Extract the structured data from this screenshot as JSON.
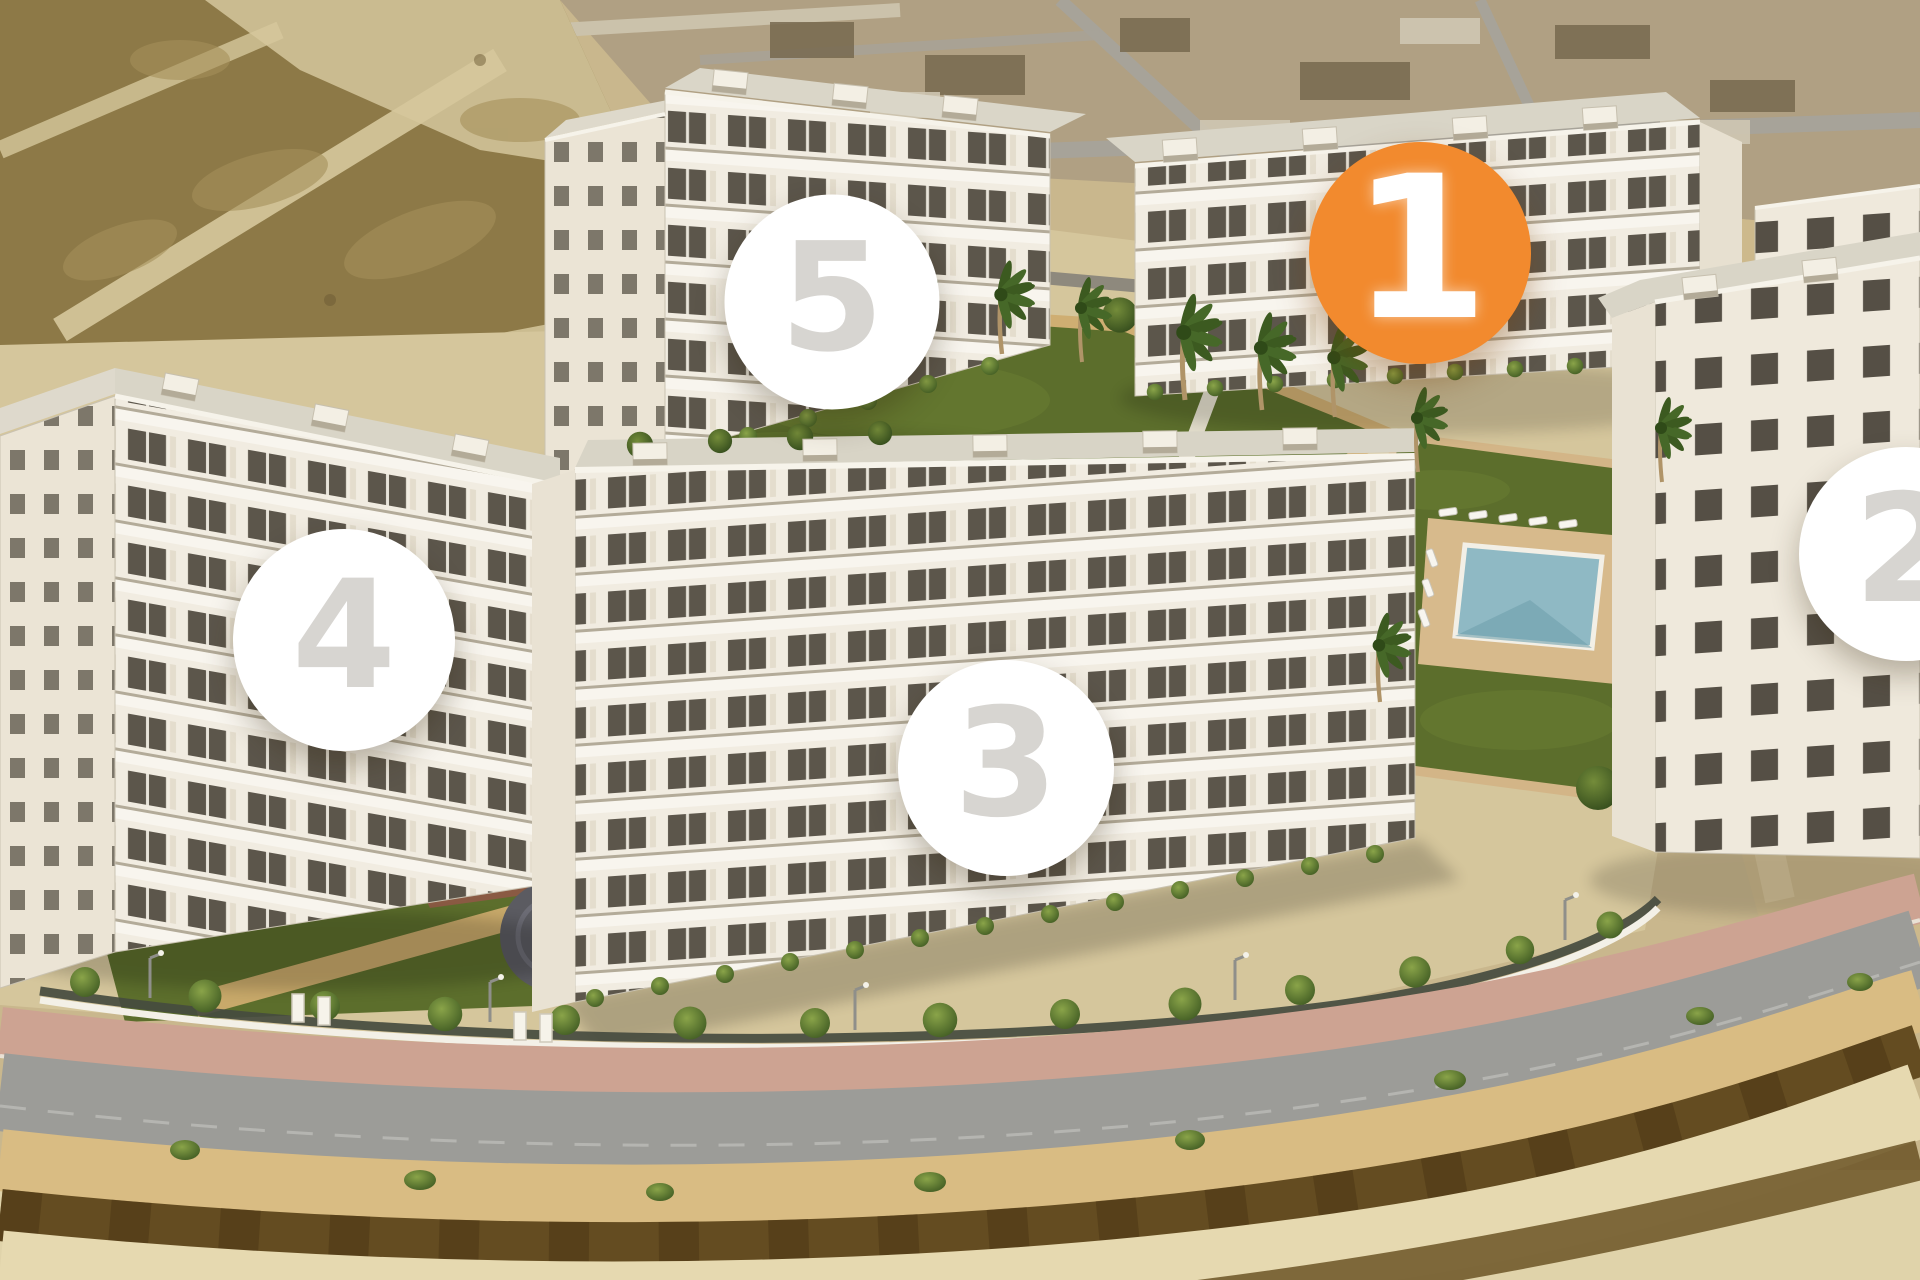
{
  "view": {
    "description": "Aerial 3D render of residential complex with numbered phase markers",
    "markers_total": 5,
    "highlighted_marker": "1"
  },
  "badges": [
    {
      "label": "1",
      "x": 1420,
      "y": 253,
      "diameter": 222,
      "state": "active"
    },
    {
      "label": "2",
      "x": 1906,
      "y": 554,
      "diameter": 214,
      "state": "default"
    },
    {
      "label": "3",
      "x": 1006,
      "y": 768,
      "diameter": 216,
      "state": "default"
    },
    {
      "label": "4",
      "x": 344,
      "y": 640,
      "diameter": 222,
      "state": "default"
    },
    {
      "label": "5",
      "x": 832,
      "y": 302,
      "diameter": 215,
      "state": "default"
    }
  ],
  "theme": {
    "badge_active_bg": "#F28A2E",
    "badge_active_text": "#FFFFFF",
    "badge_default_bg": "#FFFFFF",
    "badge_default_text": "#D7D5D1",
    "lawn_green": "#5C6E2C",
    "pool_teal": "#8FB9C4",
    "road_gray": "#9C9C98",
    "sand": "#D5C69C",
    "dirt": "#8D7947"
  }
}
